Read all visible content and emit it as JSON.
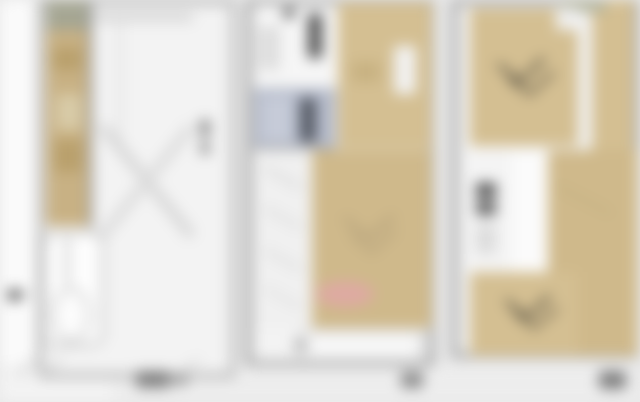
{
  "image": {
    "type": "blurred floor plan sheet",
    "panels": [
      {
        "id": "left",
        "features": [
          "wood-floor strip",
          "green entry cap",
          "stair cross",
          "wc with tub",
          "door dot marker"
        ]
      },
      {
        "id": "middle",
        "features": [
          "bathroom (blue tile)",
          "kitchen fixtures",
          "tan bedroom top-right",
          "large tan living room",
          "pink rug",
          "balcony"
        ]
      },
      {
        "id": "right",
        "features": [
          "tan bedroom with bed symbol (top)",
          "white bath core",
          "tan bedroom with bed symbol (bottom)",
          "tan side corridor"
        ]
      }
    ],
    "blurred_labels_count": 3
  },
  "palette": {
    "bg": "#e9e9e9",
    "margin": "#fafafa",
    "wall": "#9f9f9f",
    "wall_light": "#aeaeae",
    "floor": "#f3f3f3",
    "wood": "#c8b184",
    "wood2": "#d4bf92",
    "wood2_dark": "#cfb98b",
    "wood_dark": "#b9a06c",
    "wood_light": "#d8cba8",
    "green": "#a5a693",
    "green2": "#b1b29b",
    "bath": "#b5bbca",
    "bath_light": "#c6cbd8",
    "bath_dark": "#555a64",
    "fixture": "#515151",
    "pink": "#dfa9a4",
    "ink": "#6a6a6a",
    "ink_dark": "#414141",
    "ink_soft": "#5a5444",
    "stair": "#d6d6d6"
  }
}
